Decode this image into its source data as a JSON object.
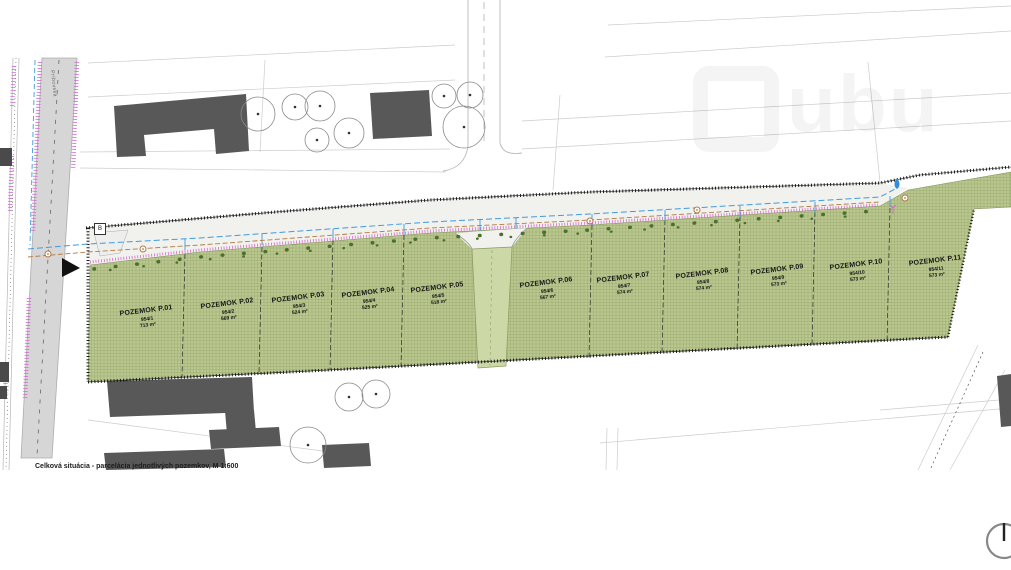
{
  "document": {
    "caption": "Celková situácia - parcelácia jednotlivých pozemkov, M 1:600",
    "scale": "M 1:600"
  },
  "watermark": {
    "text": "ubu"
  },
  "street": {
    "name": "Príbovská"
  },
  "markers": {
    "connection_box_label": "B"
  },
  "plots": [
    {
      "name": "POZEMOK P.01",
      "parcel": "954/1",
      "area": "713 m²"
    },
    {
      "name": "POZEMOK P.02",
      "parcel": "954/2",
      "area": "569 m²"
    },
    {
      "name": "POZEMOK P.03",
      "parcel": "954/3",
      "area": "524 m²"
    },
    {
      "name": "POZEMOK P.04",
      "parcel": "954/4",
      "area": "525 m²"
    },
    {
      "name": "POZEMOK P.05",
      "parcel": "954/5",
      "area": "518 m²"
    },
    {
      "name": "POZEMOK P.06",
      "parcel": "954/6",
      "area": "567 m²"
    },
    {
      "name": "POZEMOK P.07",
      "parcel": "954/7",
      "area": "574 m²"
    },
    {
      "name": "POZEMOK P.08",
      "parcel": "954/8",
      "area": "574 m²"
    },
    {
      "name": "POZEMOK P.09",
      "parcel": "954/9",
      "area": "573 m²"
    },
    {
      "name": "POZEMOK P.10",
      "parcel": "954/10",
      "area": "573 m²"
    },
    {
      "name": "POZEMOK P.11",
      "parcel": "954/11",
      "area": "573 m²"
    }
  ],
  "icons": {
    "north_arrow": "north-arrow-icon",
    "water_drop": "water-drop-icon",
    "utility_marker": "utility-marker-icon",
    "flow_arrow": "flow-direction-arrow-icon",
    "logo": "house-logo-icon"
  },
  "colors": {
    "parcel_green": "#bac88f",
    "access_green": "#ccd8a6",
    "road_gray": "#d6d6d6",
    "building_gray": "#585858",
    "utility_blue": "#3f9be0",
    "utility_brown": "#b07a45",
    "boundary_magenta": "#d668cc",
    "bush_green": "#4c6f2f"
  }
}
